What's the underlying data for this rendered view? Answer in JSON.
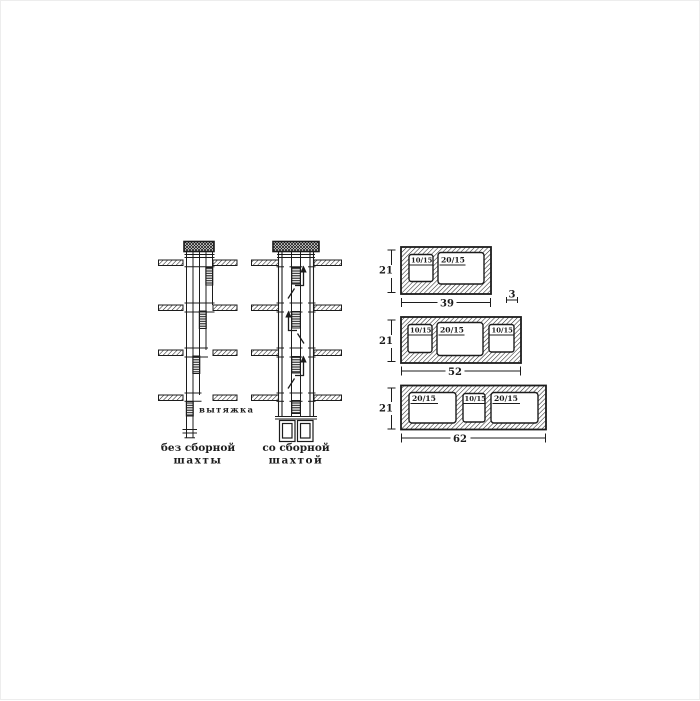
{
  "left_shaft": {
    "caption_line1": "без сборной",
    "caption_line2": "шахты",
    "exhaust_label": "вытяжка"
  },
  "right_shaft": {
    "caption_line1": "со сборной",
    "caption_line2": "шахтой"
  },
  "blocks": [
    {
      "height_dim": "21",
      "width_dim": "39",
      "wall_dim": "3",
      "openings": [
        "10/15",
        "20/15"
      ]
    },
    {
      "height_dim": "21",
      "width_dim": "52",
      "openings": [
        "10/15",
        "20/15",
        "10/15"
      ]
    },
    {
      "height_dim": "21",
      "width_dim": "62",
      "openings": [
        "20/15",
        "10/15",
        "20/15"
      ]
    }
  ],
  "colors": {
    "ink": "#1c1c1c",
    "paper": "#ffffff"
  }
}
